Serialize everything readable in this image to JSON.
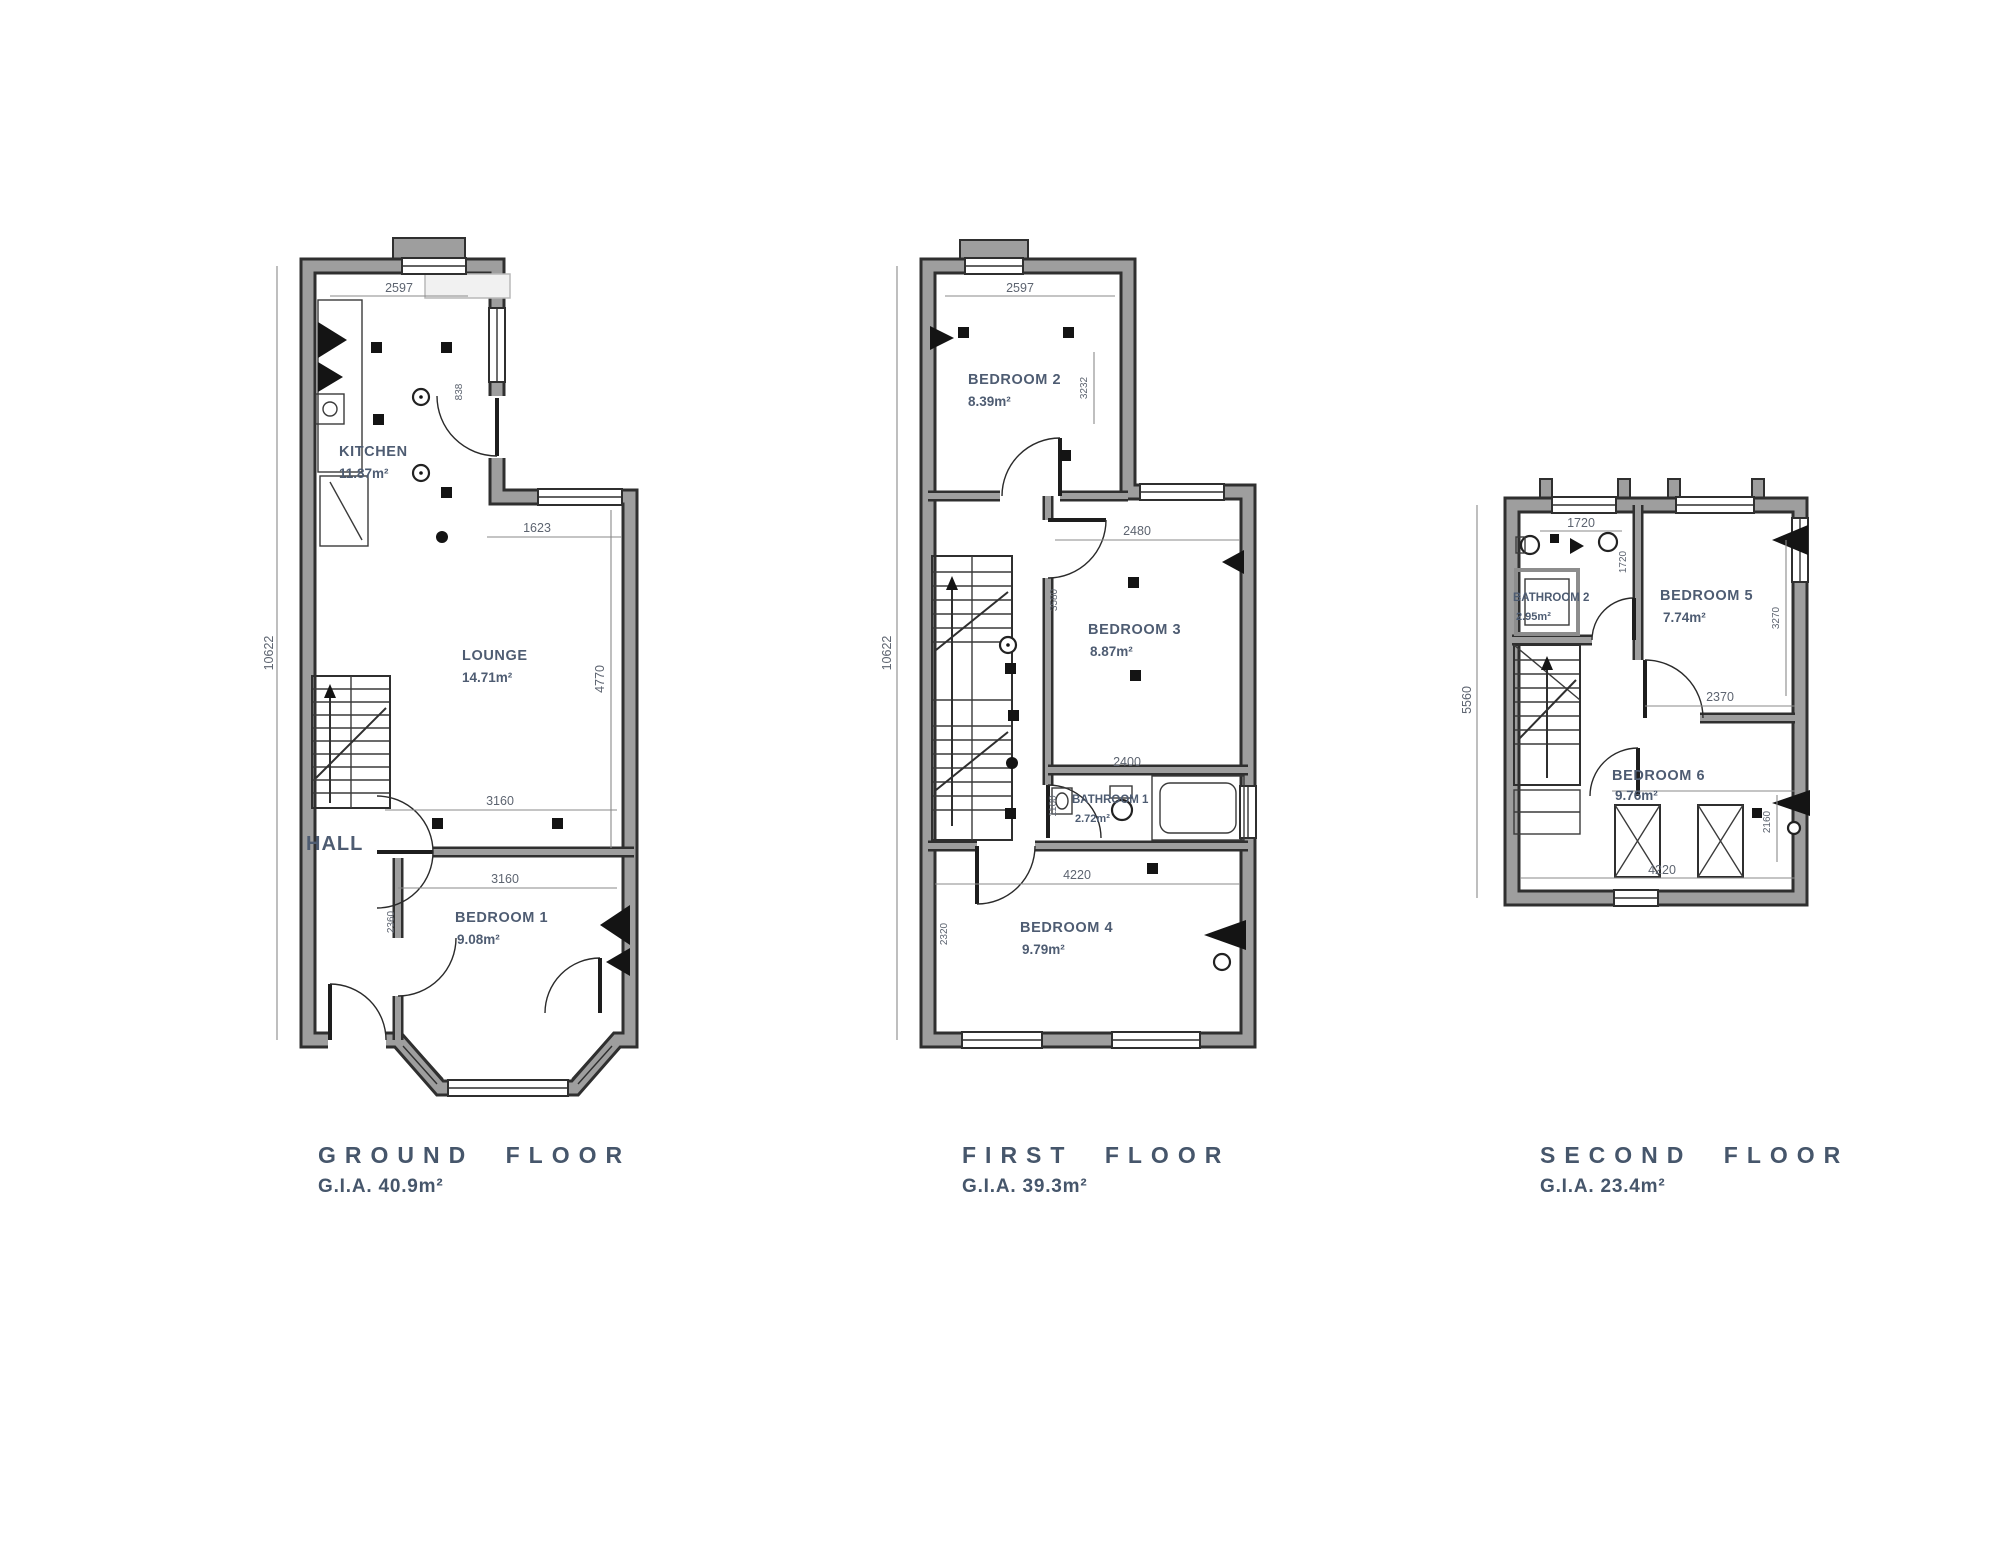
{
  "colors": {
    "background": "#ffffff",
    "wall_core": "#9e9e9e",
    "wall_edge": "#2f2f2f",
    "room_label_text": "#4e5c72",
    "caption_text": "#46566b",
    "dimension_text": "#5d6470"
  },
  "floors": [
    {
      "caption": "GROUND FLOOR",
      "gia": "G.I.A. 40.9m²",
      "rooms": [
        {
          "label": "KITCHEN",
          "area": "11.87m²"
        },
        {
          "label": "LOUNGE",
          "area": "14.71m²"
        },
        {
          "label": "HALL"
        },
        {
          "label": "BEDROOM 1",
          "area": "9.08m²"
        }
      ],
      "dims": {
        "width_top": "2597",
        "height_left": "10622",
        "lounge_top": "1623",
        "lounge_height": "4770",
        "hall_width": "3160",
        "bedroom1_width": "3160",
        "bedroom1_height": "2360",
        "kitchen_door": "838"
      }
    },
    {
      "caption": "FIRST FLOOR",
      "gia": "G.I.A. 39.3m²",
      "rooms": [
        {
          "label": "BEDROOM 2",
          "area": "8.39m²"
        },
        {
          "label": "BEDROOM 3",
          "area": "8.87m²"
        },
        {
          "label": "BATHROOM 1",
          "area": "2.72m²"
        },
        {
          "label": "BEDROOM 4",
          "area": "9.79m²"
        }
      ],
      "dims": {
        "width_top": "2597",
        "height_left": "10622",
        "bedroom2_height": "3232",
        "bedroom3_top": "2480",
        "bedroom3_height": "3580",
        "bathroom_top": "2400",
        "bathroom_height": "1100",
        "bedroom4_top": "4220",
        "bedroom4_height": "2320"
      }
    },
    {
      "caption": "SECOND FLOOR",
      "gia": "G.I.A. 23.4m²",
      "rooms": [
        {
          "label": "BATHROOM 2",
          "area": "2.95m²"
        },
        {
          "label": "BEDROOM 5",
          "area": "7.74m²"
        },
        {
          "label": "BEDROOM 6",
          "area": "9.76m²"
        }
      ],
      "dims": {
        "bathroom_top": "1720",
        "height_left": "5560",
        "bathroom_height": "1720",
        "bedroom5_height": "3270",
        "bedroom5_bottom": "2370",
        "bedroom6_height": "2160",
        "bottom": "4220"
      }
    }
  ]
}
